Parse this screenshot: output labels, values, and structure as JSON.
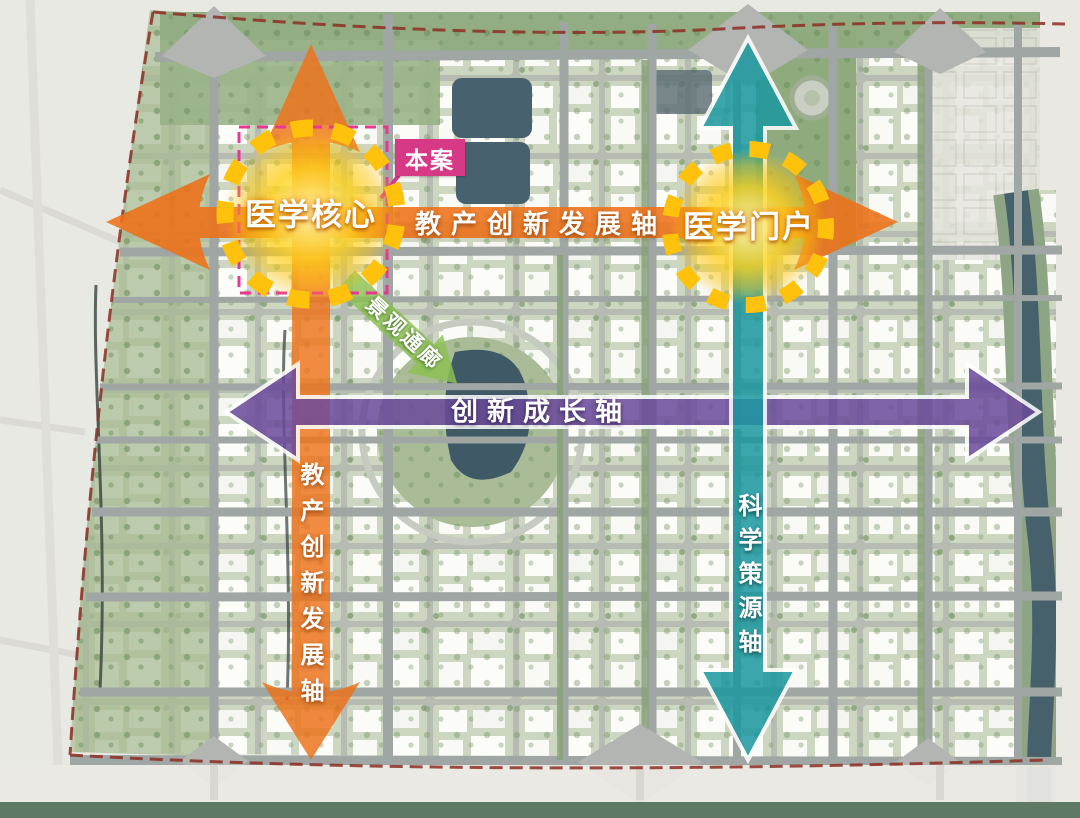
{
  "map_title": "医学城市规划结构图",
  "nodes": [
    {
      "id": "medical-core",
      "label": "医学核心"
    },
    {
      "id": "medical-gateway",
      "label": "医学门户"
    }
  ],
  "axes": [
    {
      "id": "industry-education-axis-horizontal",
      "label": "教产创新发展轴",
      "direction": "horizontal",
      "color": "#ee7118"
    },
    {
      "id": "industry-education-axis-vertical",
      "label": "教产创新发展轴",
      "direction": "vertical",
      "color": "#ee7118"
    },
    {
      "id": "innovation-growth-axis",
      "label": "创新成长轴",
      "direction": "horizontal",
      "color": "#6b4a9c"
    },
    {
      "id": "science-source-axis",
      "label": "科学策源轴",
      "direction": "vertical",
      "color": "#1b98a0"
    }
  ],
  "corridor": {
    "label": "景观通廊",
    "color": "#8cc152"
  },
  "site": {
    "callout_label": "本案",
    "boundary_color": "#d63a86"
  },
  "colors": {
    "axis_orange": "#ee7118",
    "axis_purple": "#6b4a9c",
    "axis_teal": "#1b98a0",
    "corridor_green": "#8cc152",
    "node_yellow": "#fec20c",
    "site_magenta": "#d63a86",
    "boundary_dash_red": "#8c2e23",
    "water": "#46616c",
    "park_green": "#a9bc97"
  }
}
